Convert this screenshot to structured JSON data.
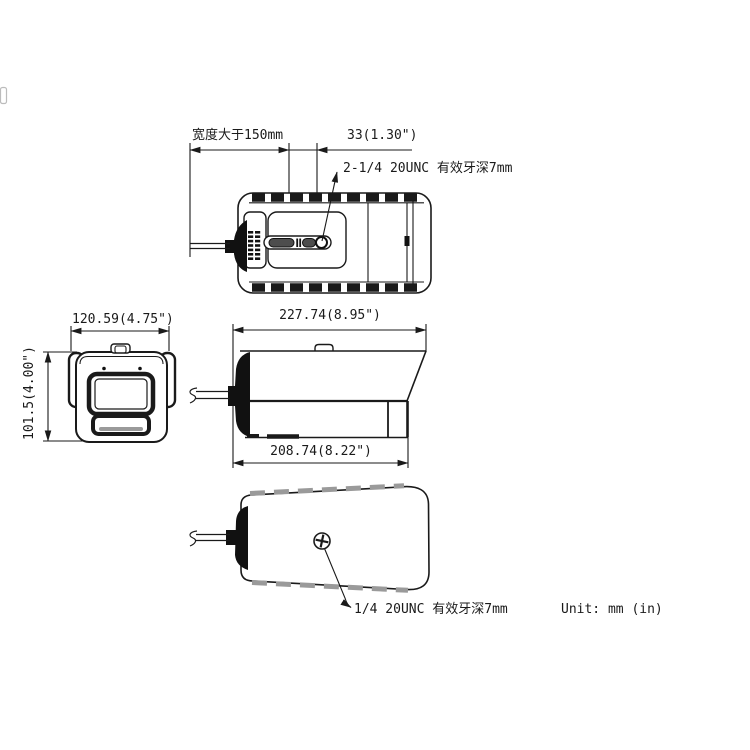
{
  "drawing": {
    "title_context": "bullet camera dimensional drawing",
    "labels": {
      "clearance_note": "宽度大于150mm",
      "hole_spacing": "33(1.30\")",
      "top_thread_note": "2-1/4 20UNC 有效牙深7mm",
      "front_width": "120.59(4.75\")",
      "front_height": "101.5(4.00\")",
      "overall_length": "227.74(8.95\")",
      "body_length": "208.74(8.22\")",
      "bottom_thread_note": "1/4 20UNC 有效牙深7mm",
      "unit_note": "Unit: mm (in)"
    },
    "colors": {
      "ink": "#1a1a1a",
      "dark_fill": "#111111",
      "fin_gray": "#9a9a9a",
      "background": "#ffffff"
    }
  }
}
